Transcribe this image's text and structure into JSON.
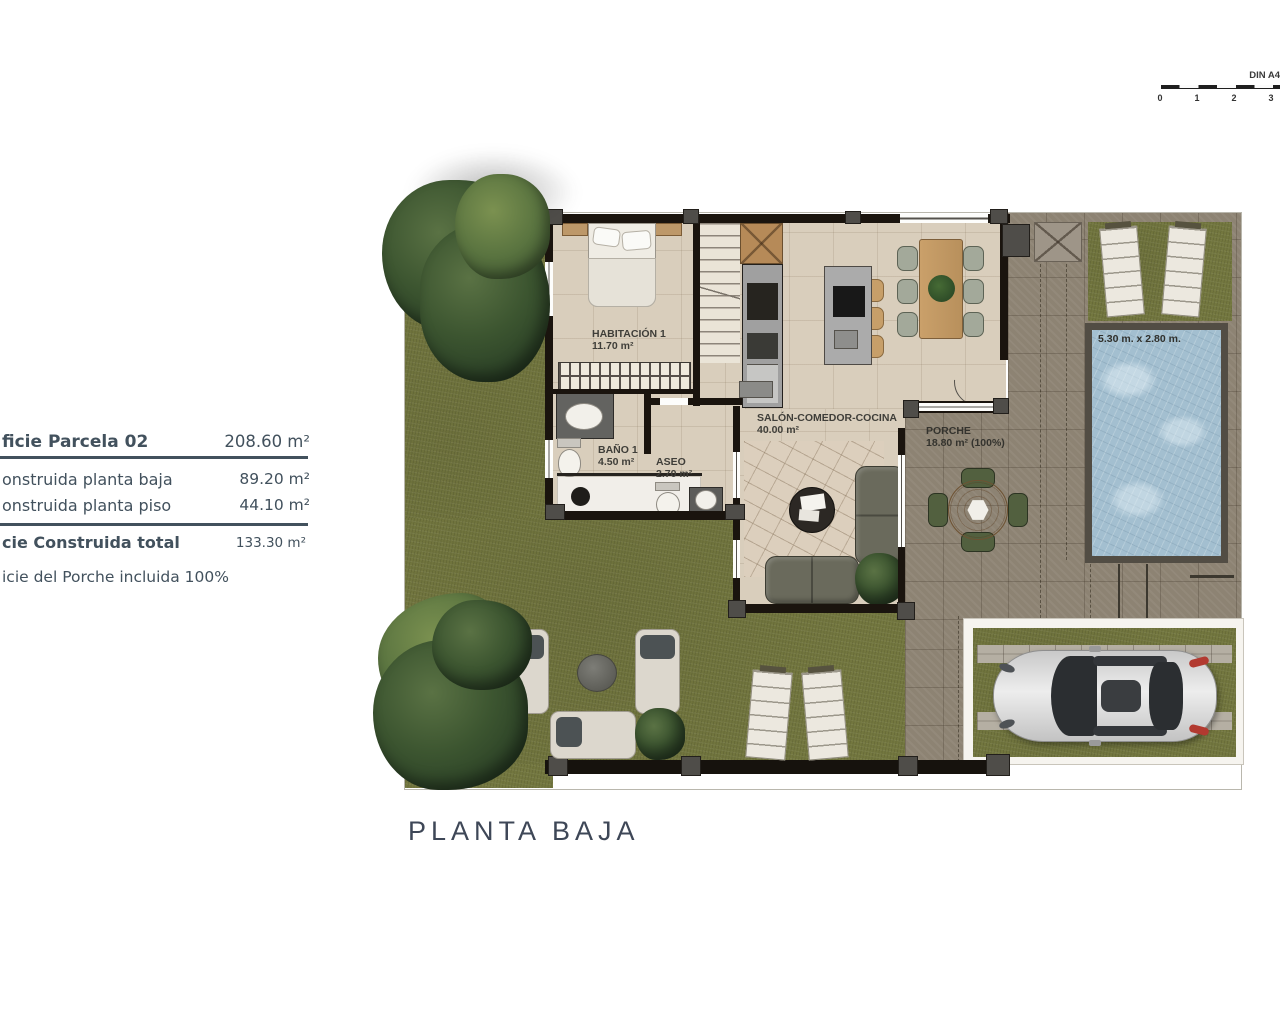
{
  "title": "PLANTA BAJA",
  "scale_bar": {
    "label": "DIN A4",
    "ticks": [
      "0",
      "1",
      "2",
      "3"
    ]
  },
  "area_table": {
    "rows": [
      {
        "label": "ficie Parcela 02",
        "value": "208.60 m²"
      },
      {
        "label": "onstruida planta baja",
        "value": "89.20 m²"
      },
      {
        "label": "onstruida planta piso",
        "value": "44.10 m²"
      },
      {
        "label": "cie Construida total",
        "value": "133.30 m²"
      },
      {
        "label": "icie del Porche incluida 100%",
        "value": ""
      }
    ]
  },
  "rooms": {
    "habitacion1": {
      "name": "HABITACIÓN 1",
      "area": "11.70 m²"
    },
    "bano1": {
      "name": "BAÑO 1",
      "area": "4.50 m²"
    },
    "aseo": {
      "name": "ASEO",
      "area": "2.70 m²"
    },
    "salon": {
      "name": "SALÓN-COMEDOR-COCINA",
      "area": "40.00 m²"
    },
    "porche": {
      "name": "PORCHE",
      "area": "18.80 m² (100%)"
    }
  },
  "pool": {
    "dimensions": "5.30 m. x 2.80 m."
  },
  "palette": {
    "grass": "#73773f",
    "terrace_tile": "#8d8373",
    "pool_water": "#a3bfd0",
    "interior_floor": "#d9cebc",
    "wall": "#1a140e",
    "table_text": "#42515d"
  }
}
